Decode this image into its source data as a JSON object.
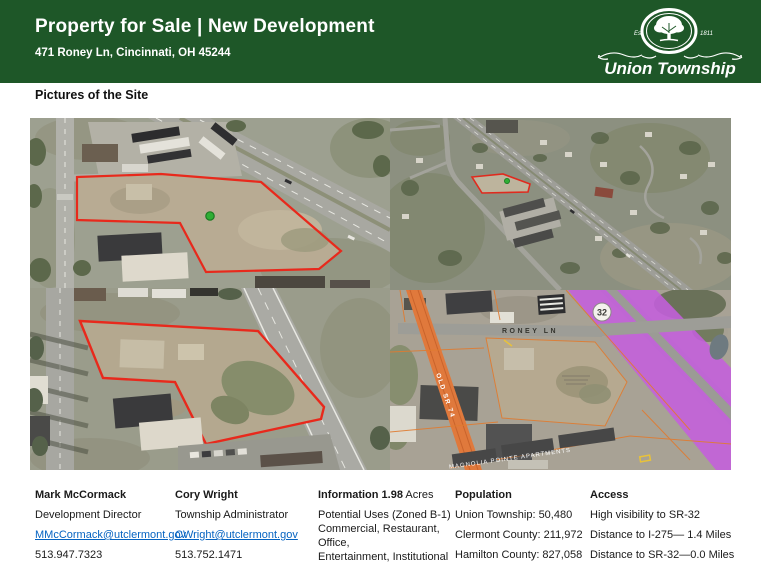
{
  "header": {
    "title": "Property for Sale | New Development",
    "address": "471 Roney Ln, Cincinnati, OH 45244",
    "logo": {
      "name": "Union Township",
      "est": "Est.",
      "year": "1811"
    }
  },
  "content": {
    "pictures_heading": "Pictures of the Site"
  },
  "maps": {
    "roney_ln_label": "RONEY LN",
    "old_sr_74_label": "OLD SR 74",
    "route_shield": "32",
    "apartments_label": "MAGNOLIA POINTE APARTMENTS"
  },
  "footer": {
    "contact_1": {
      "name": "Mark McCormack",
      "title": "Development Director",
      "email": "MMcCormack@utclermont.gov",
      "phone": "513.947.7323"
    },
    "contact_2": {
      "name": "Cory Wright",
      "title": "Township Administrator",
      "email": "CWright@utclermont.gov",
      "phone": "513.752.1471"
    },
    "information": {
      "heading_bold": "Information 1.98",
      "heading_regular": " Acres",
      "line_1": "Potential Uses (Zoned B-1)",
      "line_2": "Commercial, Restaurant, Office,",
      "line_3": "Entertainment, Institutional"
    },
    "population": {
      "heading": "Population",
      "item_1": "Union Township: 50,480",
      "item_2": "Clermont County: 211,972",
      "item_3": "Hamilton County: 827,058"
    },
    "access": {
      "heading": "Access",
      "item_1": "High visibility to SR-32",
      "item_2": "Distance to I-275— 1.4 Miles",
      "item_3": "Distance to SR-32—0.0 Miles"
    }
  },
  "colors": {
    "header_green": "#1E5728",
    "link_blue": "#0563C1",
    "parcel_red": "#E8291C",
    "highlight_purple": "#C45FDD",
    "highlight_orange": "#E0793C",
    "marker_green": "#2FAE35"
  }
}
